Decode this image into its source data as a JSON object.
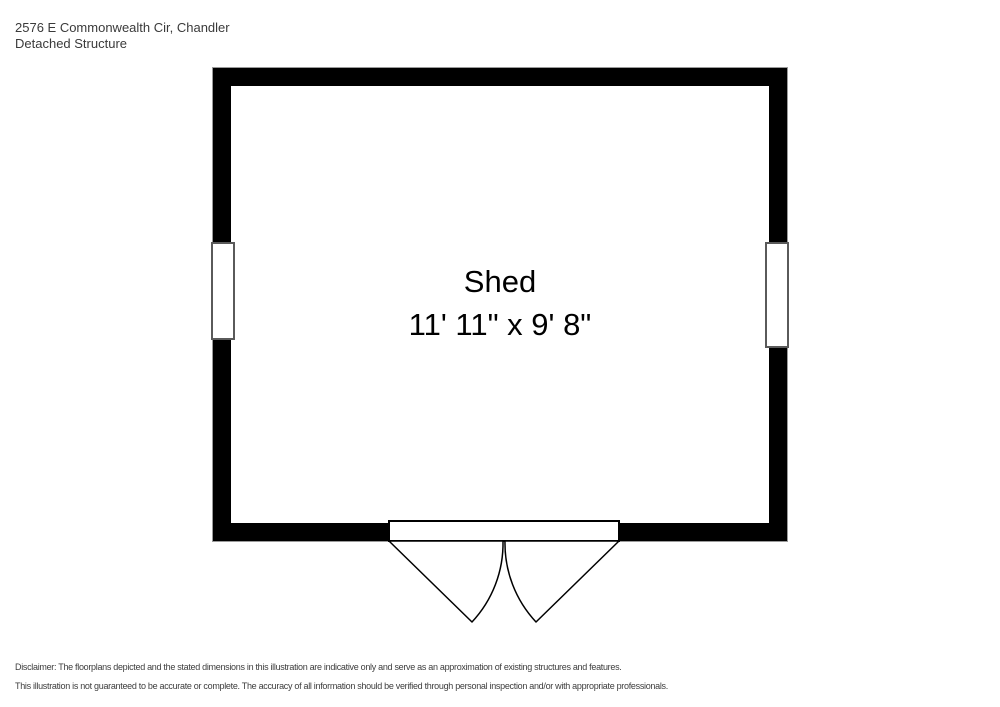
{
  "page": {
    "background_color": "#ffffff"
  },
  "header": {
    "address": "2576 E Commonwealth Cir, Chandler",
    "structure_type": "Detached Structure"
  },
  "floorplan": {
    "room": {
      "name": "Shed",
      "dimensions": "11' 11\" x 9' 8\""
    },
    "features": [
      "window-left-wall",
      "window-right-wall",
      "double-outswing-door-bottom-wall"
    ],
    "colors": {
      "wall": "#000000",
      "interior": "#ffffff",
      "window_frame": "#5a5a5a",
      "outer_outline": "#9a9a9a",
      "door_line": "#000000"
    }
  },
  "footer": {
    "disclaimer_line1": "Disclaimer: The floorplans depicted and the stated dimensions in this illustration are indicative only and serve as an approximation of existing structures and features.",
    "disclaimer_line2": "This illustration is not guaranteed to be accurate or complete. The accuracy of all information should be verified through personal inspection and/or with appropriate professionals."
  }
}
